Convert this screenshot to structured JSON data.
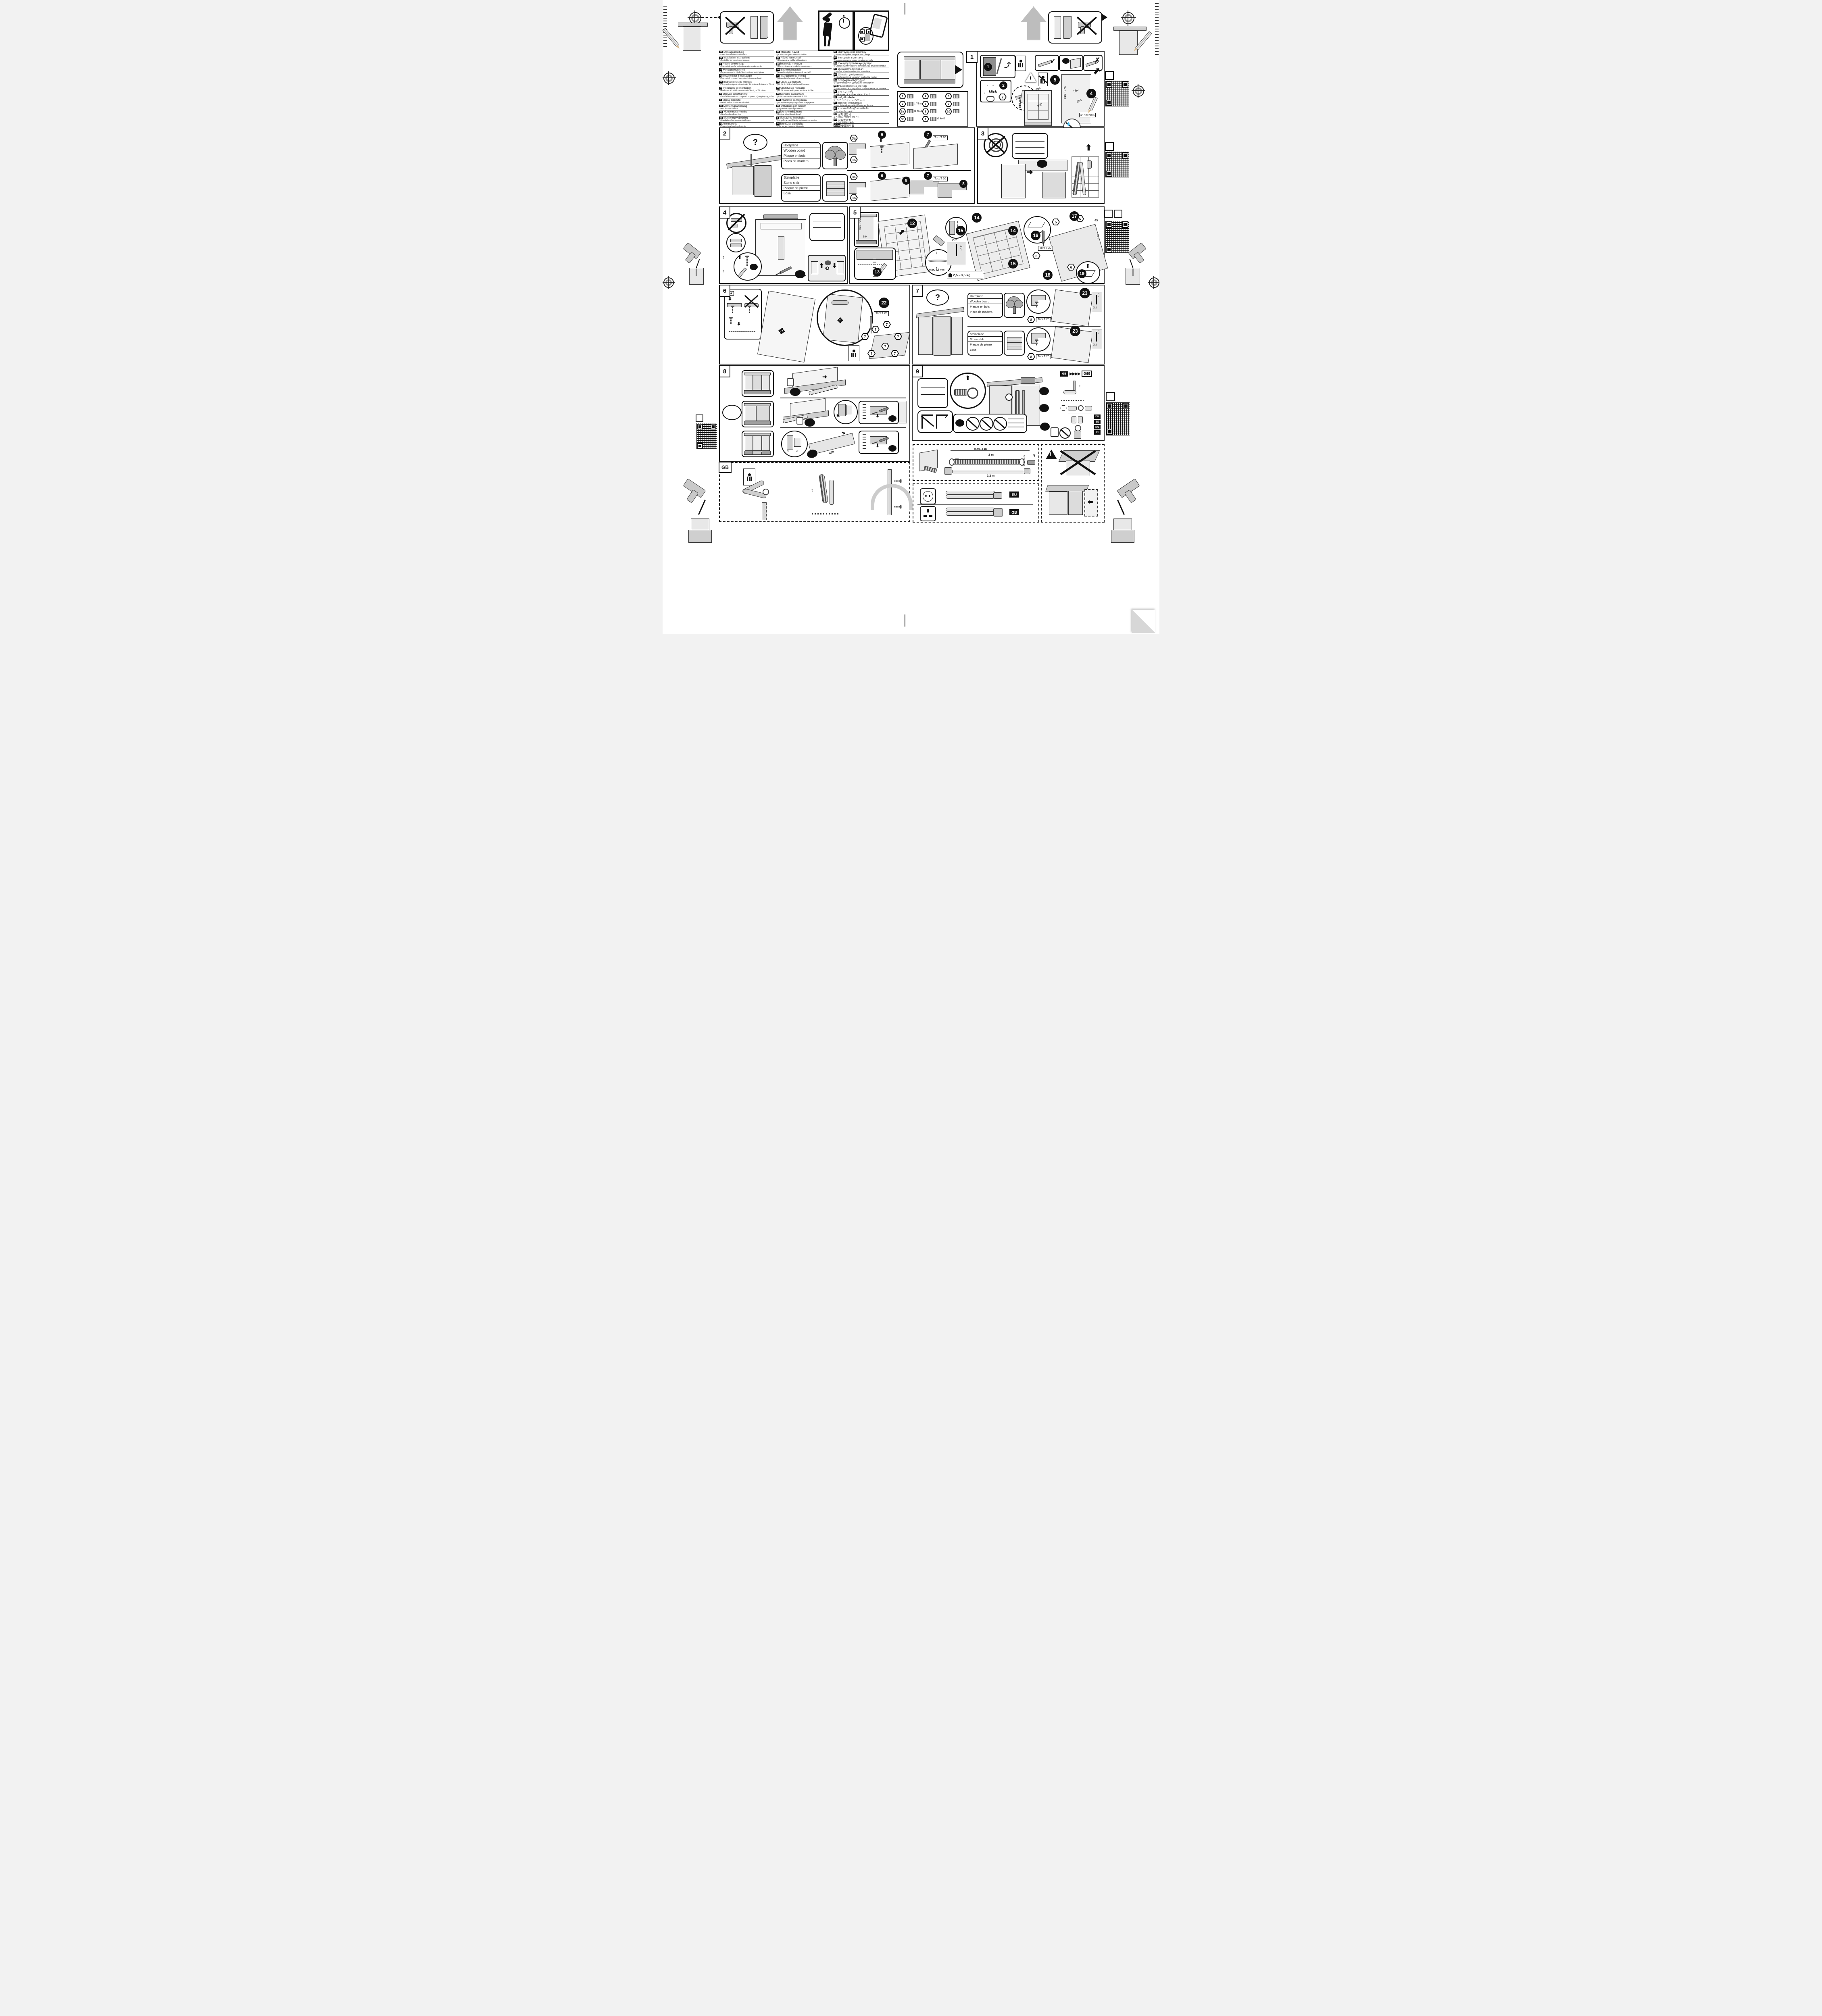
{
  "doc": {
    "type": "dishwasher-installation-sheet"
  },
  "icons": {
    "question": "?",
    "check": "✓",
    "cross": "✗",
    "ok": "ok",
    "klick": "klick",
    "asterisk": "*)",
    "arrows_right": "▶▶▶▶",
    "arrow_up": "⬆",
    "arrow_down": "⬇",
    "rotate": "⟲",
    "move": "✥"
  },
  "num": {
    "n1": "1",
    "n2": "2",
    "n3": "3",
    "n4": "4",
    "n5": "5",
    "n6": "6",
    "n7": "7",
    "n8": "8",
    "n9": "9",
    "n12": "12",
    "n13": "13",
    "n14": "14",
    "n15": "15",
    "n16": "16",
    "n17": "17",
    "n18": "18",
    "n19": "19",
    "n22": "22",
    "n23": "23",
    "h3a": "3a",
    "h3b": "3b"
  },
  "languages": {
    "columns": [
      {
        "items": [
          {
            "code": "de",
            "title": "Montageanleitung",
            "note": "*) über Kundendienst erhältlich"
          },
          {
            "code": "en",
            "title": "Installation instructions",
            "note": "*) Available from customer service"
          },
          {
            "code": "fr",
            "title": "Notice de montage",
            "note": "*) Disponible par le biais du service après-vente"
          },
          {
            "code": "nl",
            "title": "Montagevoorschrift",
            "note": "*) Tegen meerprijs bij de Servicedienst verkrijgbaar"
          },
          {
            "code": "it",
            "title": "Istruzioni per il montaggio",
            "note": "*) Disponibili presso il servizio assistenza clienti"
          },
          {
            "code": "es",
            "title": "Instrucciones de montaje",
            "note": "*) Se puede adquirir a través del Servicio de Asistencia Técnica Oficial de la marca"
          },
          {
            "code": "pt",
            "title": "Instruções de montagem",
            "note": "*) Pode ser adquirido nos nossos Serviços Técnicos"
          },
          {
            "code": "el",
            "title": "Οδηγίες τοποθέτησης",
            "note": "*) Διατίθενται από την υπηρεσία τεχνικής εξυπηρέτησης πελατών"
          },
          {
            "code": "tr",
            "title": "Montaj kılavuzu",
            "note": "*) Yetkili servis üzerinden alınabilir"
          },
          {
            "code": "sv",
            "title": "Monteringsanvisning",
            "note": "*) kan fås via Service"
          },
          {
            "code": "no",
            "title": "Monteringsanvisning",
            "note": "*) fåes hos kundeservice"
          },
          {
            "code": "da",
            "title": "Monteringsvejledning",
            "note": "*) Kan købes hos serviceafdelingen"
          },
          {
            "code": "fi",
            "title": "Asennusohje",
            "note": "*) Saatavissa huoltopalvelusta"
          }
        ]
      },
      {
        "items": [
          {
            "code": "cs",
            "title": "Montážní návod",
            "note": "*) K dispozici přes servisní službu"
          },
          {
            "code": "sk",
            "title": "Návod na montáž",
            "note": "*) Dostanete v službe zákazníkom"
          },
          {
            "code": "pl",
            "title": "Instrukcja montażu",
            "note": "*) Do uzyskania w punkcie serwisowym"
          },
          {
            "code": "hu",
            "title": "Szerelési utasítás",
            "note": "*) A vevőszolgálaton keresztül kapható:"
          },
          {
            "code": "ro",
            "title": "Instrucțiune de montaj",
            "note": "*) obtenabilă la serviciul pentru clienți"
          },
          {
            "code": "hr",
            "title": "Uputa za montažu",
            "note": "*) može dobiti kod službe održavanja"
          },
          {
            "code": "sr",
            "title": "Uputstvo za montažu",
            "note": "*) Može se nabaviti preko servisne službe"
          },
          {
            "code": "sl",
            "title": "Navodilo za montažo",
            "note": "*) Lahko nabavite v servisni službi"
          },
          {
            "code": "mk",
            "title": "Упатство за монтажа",
            "note": "*) се добива преку службата за купувачи"
          },
          {
            "code": "sq",
            "title": "Udhëzues për montim",
            "note": "*) Sigurohet nëpërmjet servisit"
          },
          {
            "code": "et",
            "title": "Monteerimisjuhend",
            "note": "*) küsige klienditeeninduselt"
          },
          {
            "code": "lt",
            "title": "Montavimo instrukcija",
            "note": "*) Ją galima gauti klientų aptarnavimo servise"
          },
          {
            "code": "lv",
            "title": "Montāžas pamācība",
            "note": "*) Var saņemt servisa dienestā"
          }
        ]
      },
      {
        "items": [
          {
            "code": "ru",
            "title": "Инструкция по монтажу",
            "note": "*) Можно получить в сервисном центре"
          },
          {
            "code": "uk",
            "title": "Інструкція з монтажу",
            "note": "*) Можна отримати через сервісну службу"
          },
          {
            "code": "kk",
            "title": "Іске қосу туралы нұсқаулар!",
            "note": "*) Сервис қызмет көрсету орталығында алуына жатады"
          },
          {
            "code": "az",
            "title": "Quraşdırma təlimatları",
            "note": "*) Müştəri xidmətlərindən əldə oluna bilər"
          },
          {
            "code": "uz",
            "title": "O'rnatish yo'riqnomasi",
            "note": "*) mijozlarga xizmat ko'rsatish markazida mavjud"
          },
          {
            "code": "ka",
            "title": "მონტაჟის ინსტრუქცია",
            "note": "*) ხელმისაწვდომი კლიენტთა სამსახურში"
          },
          {
            "code": "bg",
            "title": "Ръководство за монтаж",
            "note": "*) предоставя се от службата за обслужване на клиенти"
          },
          {
            "code": "fa",
            "title": "راهنمئى مونتاژ",
            "note": "*) از مرکز خدمات پس از فرش تهیه فرمائید"
          },
          {
            "code": "ar",
            "title": "تعليمات التركيب",
            "note": "*) يمكن طلبها من مراكز خدمة العملاء"
          },
          {
            "code": "id",
            "title": "Intruksi Pemasangan",
            "note": "*) bisa didapatkan melalui Customer Service"
          },
          {
            "code": "th",
            "title": "สามารถสั่งซื้อคู่มือการติดตั้ง",
            "note": "*) ผ่านฝ่ายบริการลูกค้า"
          },
          {
            "code": "ko",
            "title": "설치 설명서",
            "note": "고객서비스 센터에서 구입 가능"
          },
          {
            "code": "zh",
            "title": "安装说明书",
            "note": "*) 可向售后服务站索取。"
          },
          {
            "code": "zh-tw",
            "title": "安裝說明書",
            "note": "*) 可向售後服務站索取"
          }
        ]
      }
    ]
  },
  "panel1": {
    "label": "1",
    "parts": [
      {
        "id": "1",
        "note": ""
      },
      {
        "id": "2",
        "note": "1,75 m"
      },
      {
        "id": "3a",
        "note": "Ø 4x16"
      },
      {
        "id": "3b",
        "note": ""
      },
      {
        "id": "4",
        "note": ""
      },
      {
        "id": "5",
        "note": ""
      },
      {
        "id": "6",
        "note": ""
      },
      {
        "id": "7",
        "note": "Ø 4x42"
      },
      {
        "id": "8",
        "note": ""
      },
      {
        "id": "9",
        "note": ""
      },
      {
        "id": "10",
        "note": ""
      }
    ],
    "dims": {
      "height": "815 mm",
      "niche": "815 - 875",
      "depth": "550",
      "width": "600",
      "top": "598",
      "depth2": "550",
      "conduit": "≈100x50m"
    }
  },
  "material": {
    "wood": [
      "Holzplatte",
      "Wooden board",
      "Plaque en bois",
      "Placa de madera"
    ],
    "stone": [
      "Steinplatte",
      "Stone slab",
      "Plaque de pierre",
      "Losa"
    ]
  },
  "common": {
    "torx": "Torx T 20"
  },
  "panel5": {
    "max725": "max. 725",
    "w594": "594",
    "gap": "max. 1,2 mm",
    "drill_d": "Ø 2",
    "drill_depth": "~12",
    "weight": "2,5 - 8,5 kg",
    "d45": "45",
    "d155": "155"
  },
  "panel7": {
    "drill_depth": "~12",
    "drill_d": "Ø 2"
  },
  "panel8": {
    "d470": "470"
  },
  "panel9": {
    "gb_small": "GB",
    "gb_big": "GB",
    "countries": [
      "DK",
      "SE",
      "NO",
      "FI"
    ]
  },
  "bottom": {
    "gb_panel_label": "GB",
    "hose": {
      "max": "max. 4 m",
      "l1": "2 m",
      "dia": "Ø 22 mm",
      "l2": "2,2 m",
      "star": "*)"
    },
    "cords": {
      "eu": "EU",
      "gb": "GB"
    }
  }
}
